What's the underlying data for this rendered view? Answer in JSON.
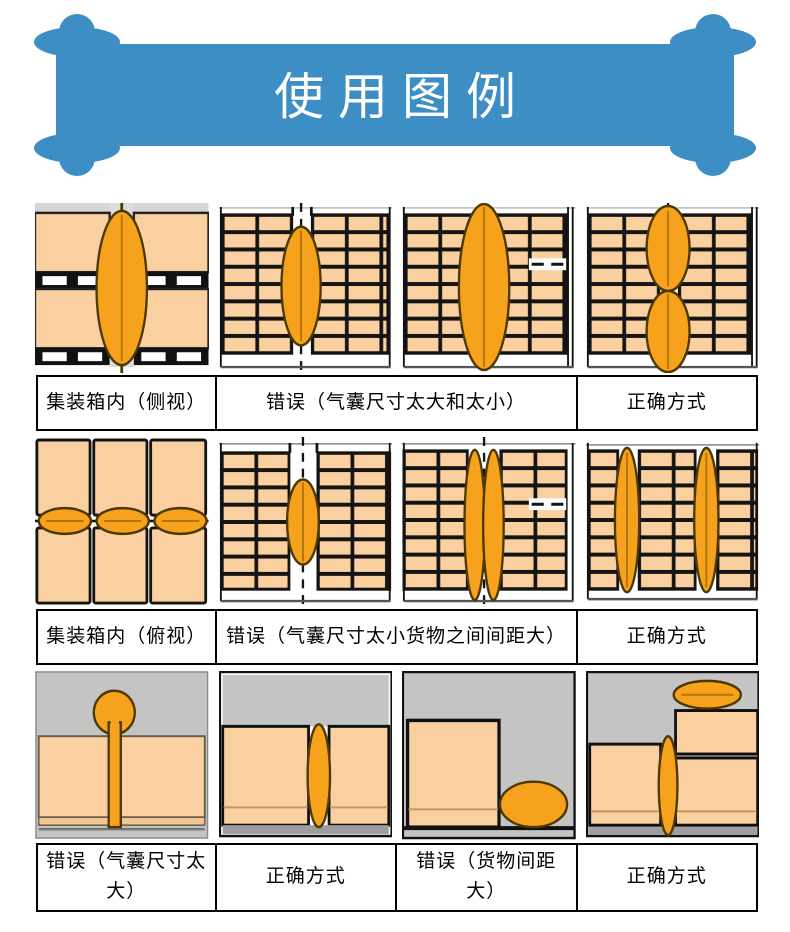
{
  "banner": {
    "title": "使用图例",
    "color": "#3E8EC6"
  },
  "colors": {
    "banner_blue": "#3E8EC6",
    "carton_peach": "#FAD0A0",
    "airbag_orange": "#F6A21D",
    "airbag_outline": "#4D3800",
    "container_gray": "#C4C4C4",
    "grid_line_black": "#141414"
  },
  "rows": [
    {
      "captions": [
        {
          "text": "集装箱内（侧视）"
        },
        {
          "text": "错误（气囊尺寸太大和太小）"
        },
        {
          "text": "正确方式"
        }
      ],
      "illustrations": [
        "container-side-view-airbag-between-cargo",
        "wrong-airbag-too-small",
        "wrong-airbag-too-large",
        "correct-two-stacked-airbags"
      ]
    },
    {
      "captions": [
        {
          "text": "集装箱内（俯视）"
        },
        {
          "text": "错误（气囊尺寸太小货物之间间距大）"
        },
        {
          "text": "正确方式"
        }
      ],
      "illustrations": [
        "container-top-view-three-airbags",
        "wrong-airbag-too-small-wide-gap",
        "wrong-two-thin-airbags-wide-gap",
        "correct-airbags-between-cargo-stacks"
      ]
    },
    {
      "captions": [
        {
          "text": "错误（气囊尺寸太大）"
        },
        {
          "text": "正确方式"
        },
        {
          "text": "错误（货物间距大）"
        },
        {
          "text": "正确方式"
        }
      ],
      "illustrations": [
        "wrong-airbag-oversized-bulging-above-cargo",
        "correct-airbag-fits-gap",
        "wrong-cargo-gap-too-large-bag-fallen",
        "correct-airbag-with-uneven-stacks"
      ]
    }
  ]
}
